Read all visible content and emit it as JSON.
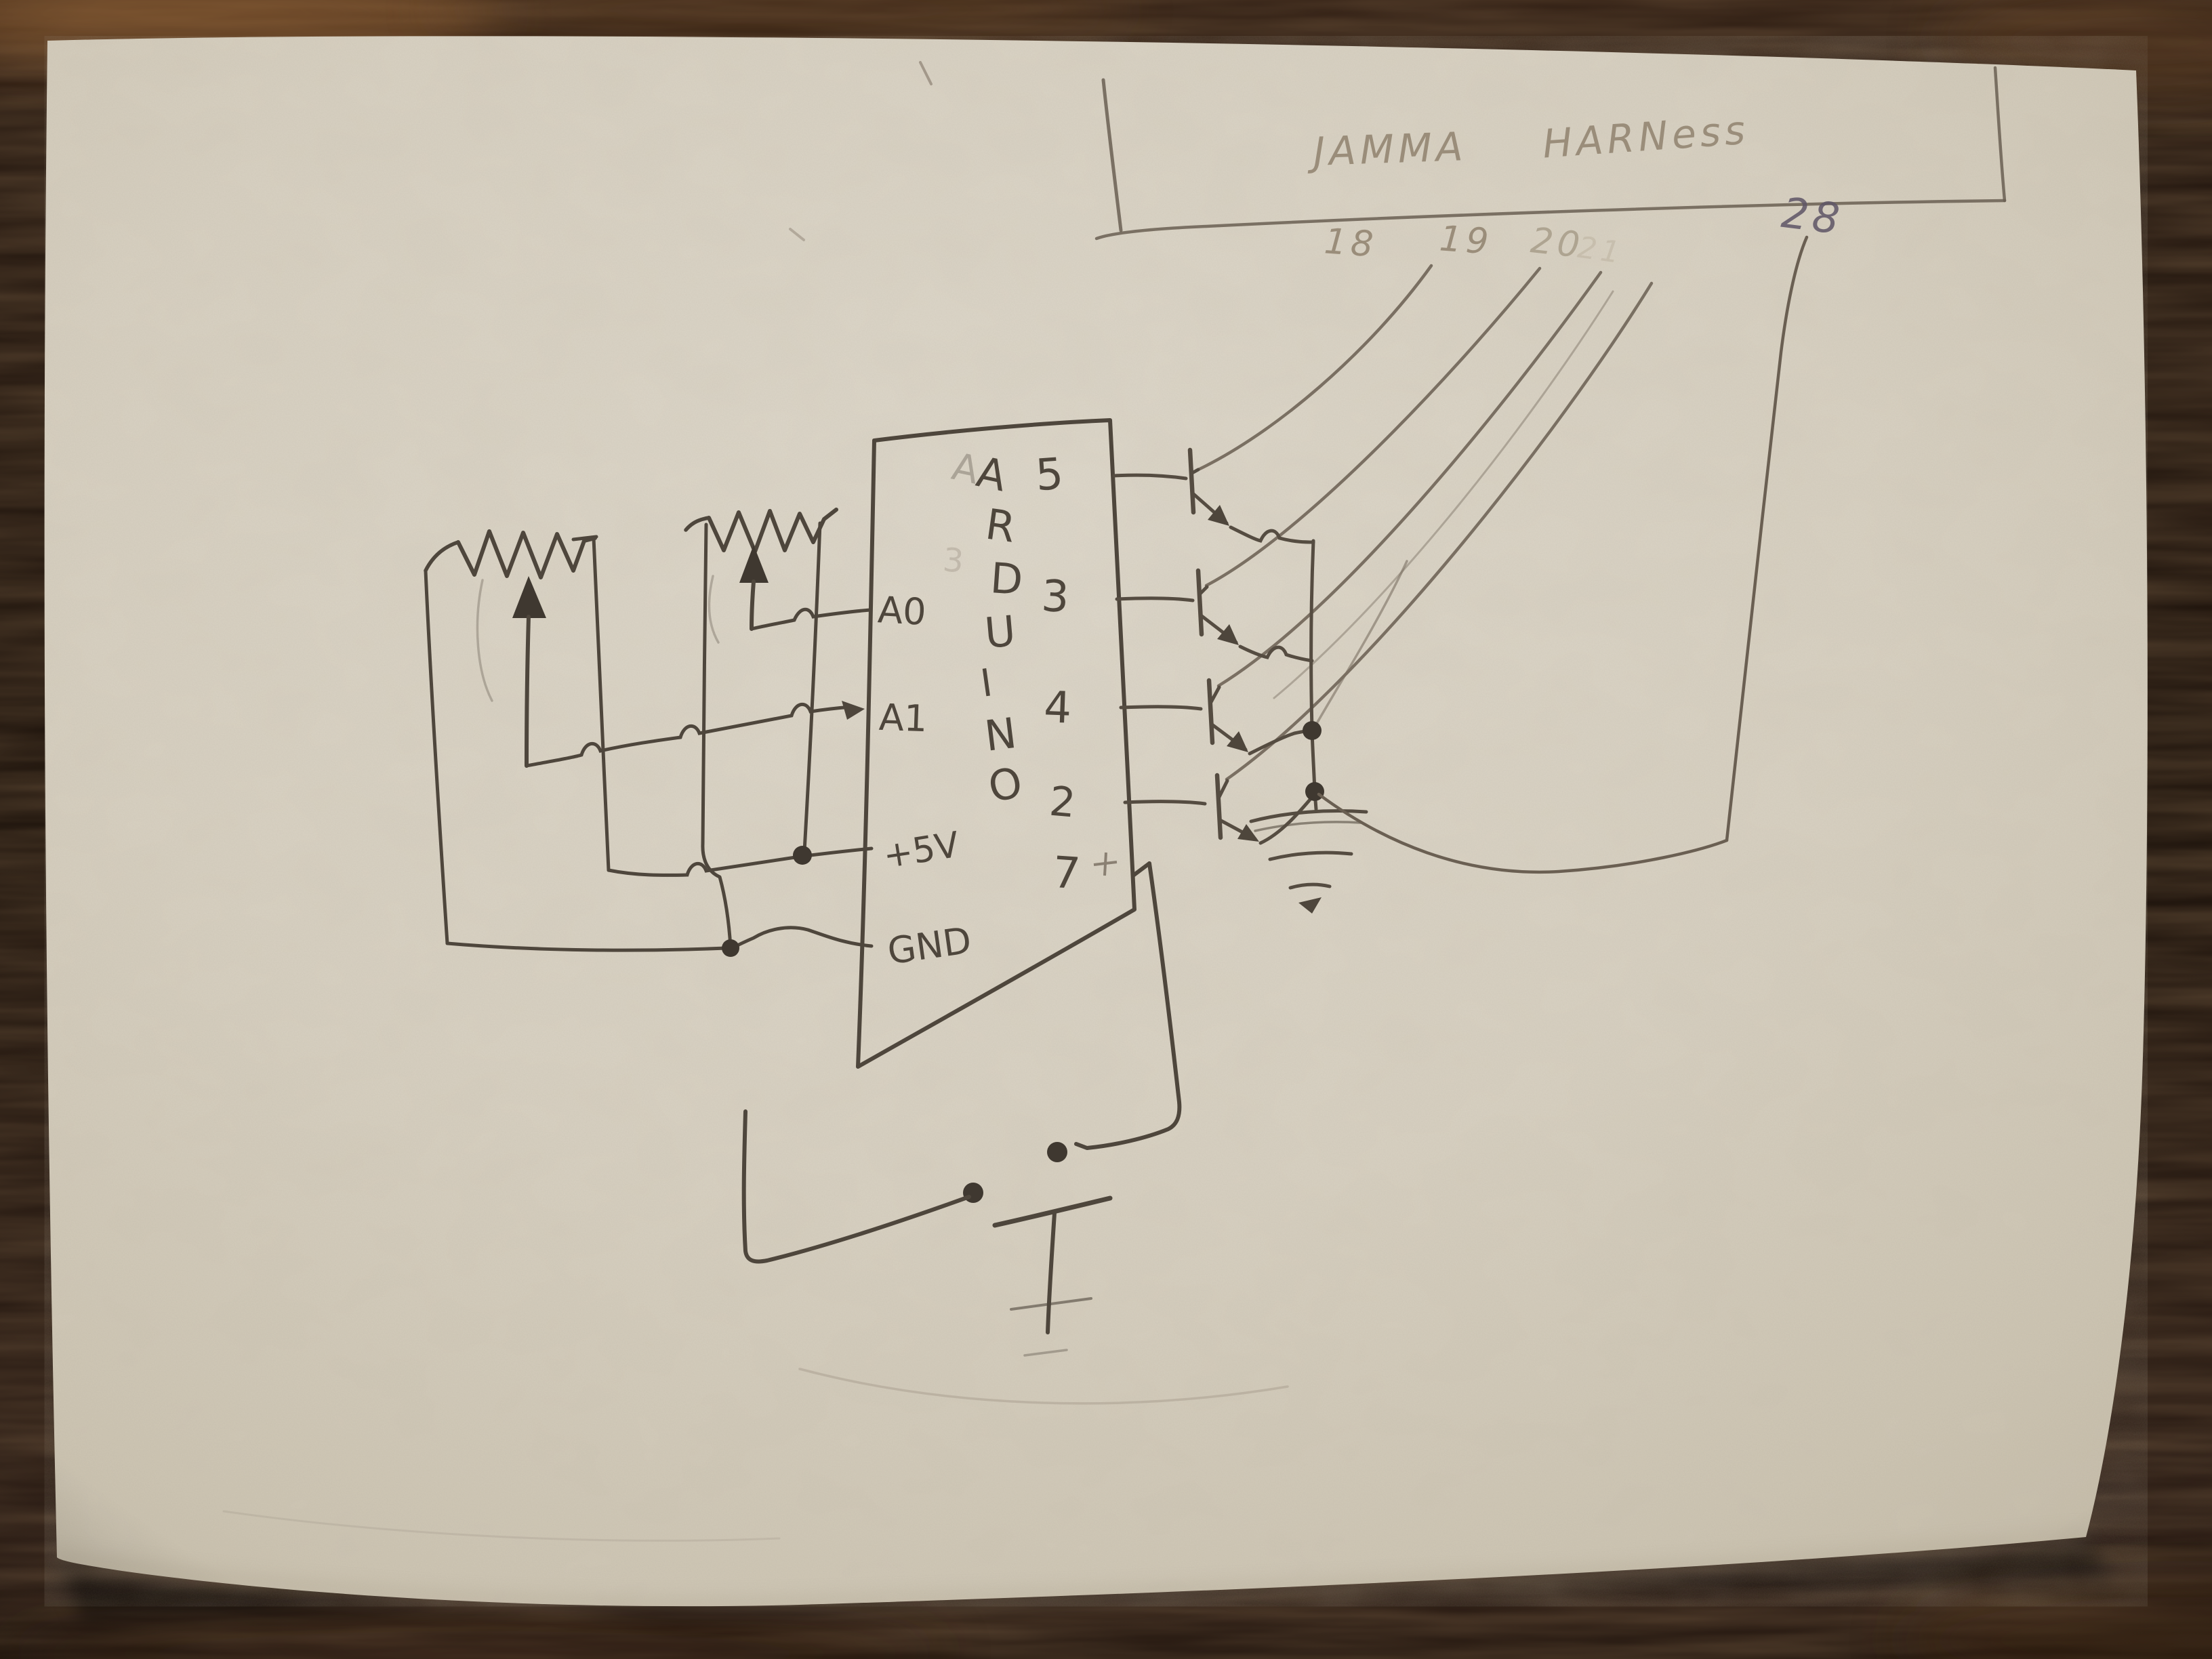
{
  "scene": {
    "kind": "photo of a hand-drawn pencil circuit schematic on white paper",
    "surface": "dark wood table"
  },
  "colors": {
    "paper": "#d8d1c2",
    "paper_shadowed": "#c4bba9",
    "pencil_dark": "#4e463c",
    "pencil_mid": "#6a5f52",
    "pencil_light": "#9a8d7a",
    "pencil_faint": "#b3a793",
    "pen_28": "#5e5566",
    "wood_dark": "#1a110b",
    "wood_highlight": "#8a5f35"
  },
  "harness": {
    "title_word1": "JAMMA",
    "title_word2": "HARNess",
    "pins": [
      "18",
      "19",
      "20",
      "21",
      "28"
    ]
  },
  "arduino": {
    "name_letters": [
      "A",
      "R",
      "D",
      "U",
      "I",
      "N",
      "O"
    ],
    "ghost_letter": "A",
    "ghost_digit": "3",
    "left_pins": [
      "A0",
      "A1",
      "+5V",
      "GND"
    ],
    "right_pins": [
      "5",
      "3",
      "4",
      "2",
      "7"
    ]
  },
  "components": {
    "potentiometer_count": 2,
    "transistor_count": 4,
    "push_button_count": 1,
    "ground_symbol_count": 1
  },
  "connections": {
    "pot1_wiper": "A1",
    "pot2_wiper": "A0",
    "pot_outer_right": "+5V",
    "pot_outer_left": "GND",
    "transistor_bases": [
      "5",
      "3",
      "4",
      "2"
    ],
    "transistor_collectors": [
      "18",
      "19",
      "20",
      "21"
    ],
    "transistor_emitters": "common rail to ground and 28",
    "pin7": "push button to GND"
  }
}
